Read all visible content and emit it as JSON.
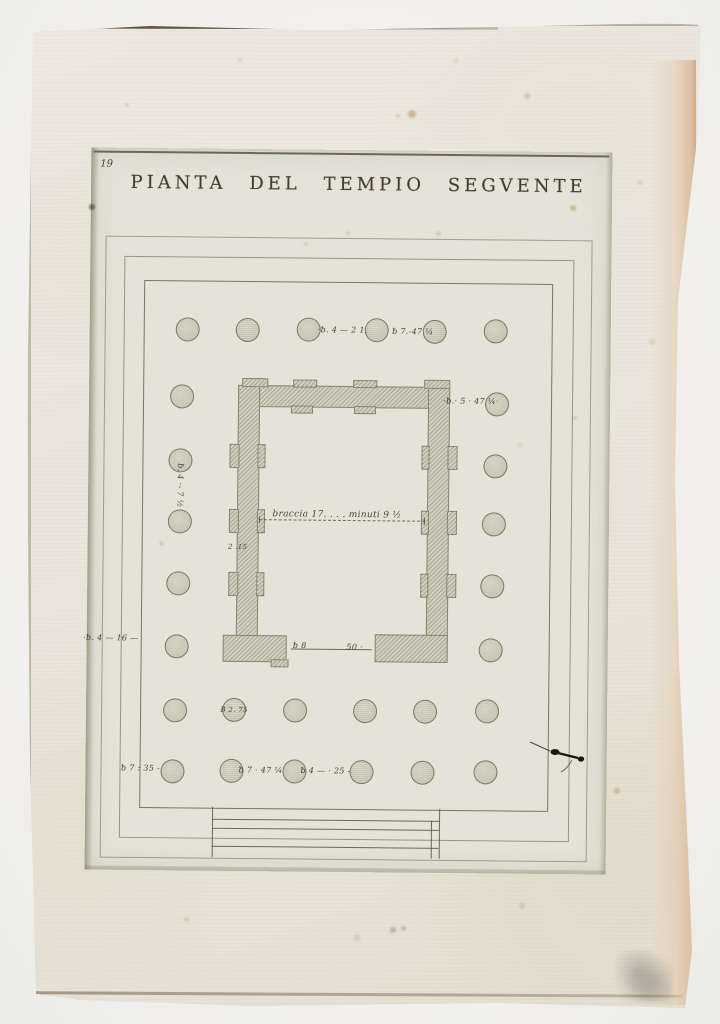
{
  "page": {
    "number": "19",
    "title": "PIANTA DEL TEMPIO SEGVENTE"
  },
  "colors": {
    "paper": "#eae6dc",
    "plate": "#e5e3d8",
    "ink": "#443d2e",
    "annotation_ink": "#483f2f",
    "wall_fill": "#d3d1c1",
    "edge_pink": "#dcc0a2"
  },
  "plan": {
    "origin": {
      "x": 88,
      "y": 150
    },
    "border_rects": [
      {
        "x": 103,
        "y": 238,
        "w": 485,
        "h": 620,
        "o": 0.5
      },
      {
        "x": 122,
        "y": 258,
        "w": 448,
        "h": 580,
        "o": 0.58
      },
      {
        "x": 142,
        "y": 282,
        "w": 407,
        "h": 526,
        "o": 0.8
      }
    ],
    "columns": {
      "radius": 12,
      "positions": [
        [
          186,
          331
        ],
        [
          246,
          331
        ],
        [
          307,
          330
        ],
        [
          375,
          330
        ],
        [
          433,
          331
        ],
        [
          494,
          330
        ],
        [
          181,
          398
        ],
        [
          496,
          403
        ],
        [
          180,
          462
        ],
        [
          495,
          465
        ],
        [
          180,
          523
        ],
        [
          494,
          523
        ],
        [
          179,
          585
        ],
        [
          493,
          585
        ],
        [
          178,
          648
        ],
        [
          492,
          649
        ],
        [
          177,
          712
        ],
        [
          236,
          711
        ],
        [
          297,
          711
        ],
        [
          367,
          711
        ],
        [
          427,
          711
        ],
        [
          489,
          710
        ],
        [
          175,
          773
        ],
        [
          234,
          772
        ],
        [
          297,
          772
        ],
        [
          364,
          772
        ],
        [
          425,
          772
        ],
        [
          488,
          771
        ]
      ]
    },
    "cella": {
      "blocks": [
        [
          237,
          386,
          212,
          22
        ],
        [
          237,
          386,
          22,
          276
        ],
        [
          427,
          386,
          22,
          274
        ],
        [
          224,
          636,
          64,
          27
        ],
        [
          376,
          634,
          73,
          28
        ],
        [
          241,
          379,
          26,
          9
        ],
        [
          292,
          380,
          24,
          8
        ],
        [
          352,
          380,
          24,
          8
        ],
        [
          423,
          379,
          26,
          9
        ],
        [
          290,
          406,
          22,
          8
        ],
        [
          353,
          406,
          22,
          8
        ],
        [
          229,
          445,
          10,
          24
        ],
        [
          229,
          510,
          10,
          24
        ],
        [
          229,
          573,
          10,
          24
        ],
        [
          257,
          445,
          8,
          24
        ],
        [
          257,
          510,
          8,
          24
        ],
        [
          257,
          573,
          8,
          24
        ],
        [
          447,
          445,
          10,
          24
        ],
        [
          447,
          510,
          10,
          24
        ],
        [
          447,
          573,
          10,
          24
        ],
        [
          421,
          445,
          8,
          24
        ],
        [
          421,
          510,
          8,
          24
        ],
        [
          421,
          573,
          8,
          24
        ],
        [
          272,
          660,
          18,
          8
        ]
      ]
    },
    "lines": [
      {
        "x": 259,
        "y": 520,
        "len": 166,
        "dir": "h",
        "dash": true,
        "name": "cella-width-dashed-line"
      },
      {
        "x": 259,
        "y": 517,
        "len": 7,
        "dir": "v",
        "dash": false,
        "name": "dashed-line-tick"
      },
      {
        "x": 424,
        "y": 517,
        "len": 7,
        "dir": "v",
        "dash": false,
        "name": "dashed-line-tick"
      },
      {
        "x": 292,
        "y": 649,
        "len": 81,
        "dir": "h",
        "dash": false,
        "name": "door-width-line"
      },
      {
        "x": 215,
        "y": 820,
        "len": 227,
        "dir": "h",
        "dash": false,
        "name": "steps-line"
      },
      {
        "x": 215,
        "y": 829,
        "len": 227,
        "dir": "h",
        "dash": false,
        "name": "steps-line"
      },
      {
        "x": 215,
        "y": 847,
        "len": 227,
        "dir": "h",
        "dash": false,
        "name": "steps-line"
      },
      {
        "x": 215,
        "y": 808,
        "len": 50,
        "dir": "v",
        "dash": false,
        "name": "steps-edge"
      },
      {
        "x": 442,
        "y": 808,
        "len": 50,
        "dir": "v",
        "dash": false,
        "name": "steps-edge"
      },
      {
        "x": 434,
        "y": 820,
        "len": 38,
        "dir": "v",
        "dash": false,
        "name": "steps-edge"
      }
    ],
    "annotations": [
      {
        "t": "·ƀ. 4 — 2 1.",
        "x": 341,
        "y": 330,
        "s": 8
      },
      {
        "t": "ƀ 7.-47 ¼",
        "x": 411,
        "y": 331,
        "s": 8
      },
      {
        "t": "·ƀ.· 5 · 47 ¼·",
        "x": 470,
        "y": 400,
        "s": 8
      },
      {
        "t": "ƀ. 4 ·- 7 ½",
        "x": 180,
        "y": 487,
        "s": 8,
        "r": 90
      },
      {
        "t": "2 .15",
        "x": 238,
        "y": 548,
        "s": 7
      },
      {
        "t": "braccia 17. . . .  minuti 9 ½",
        "x": 337,
        "y": 515,
        "s": 9
      },
      {
        "t": "·ƀ. 4 — 16 —",
        "x": 112,
        "y": 640,
        "s": 8
      },
      {
        "t": "ƀ 8",
        "x": 301,
        "y": 646,
        "s": 8
      },
      {
        "t": "50 ·",
        "x": 356,
        "y": 647,
        "s": 8
      },
      {
        "t": "B 2. 75",
        "x": 236,
        "y": 711,
        "s": 7
      },
      {
        "t": "ƀ 7 : 35 -",
        "x": 143,
        "y": 770,
        "s": 8
      },
      {
        "t": "ƀ 7 · 47 ¼",
        "x": 263,
        "y": 771,
        "s": 8
      },
      {
        "t": "ƀ 4 — · 25 -",
        "x": 328,
        "y": 771,
        "s": 8
      }
    ]
  },
  "marks": {
    "spots": [
      [
        412,
        114,
        4,
        "#b08a52",
        0.5
      ],
      [
        527,
        96,
        3,
        "#bd9a62",
        0.45
      ],
      [
        573,
        208,
        3,
        "#ae8a50",
        0.5
      ],
      [
        438,
        233,
        2.5,
        "#bd9a62",
        0.4
      ],
      [
        556,
        181,
        2,
        "#b08a52",
        0.35
      ],
      [
        640,
        182,
        2.5,
        "#c7ae85",
        0.4
      ],
      [
        652,
        342,
        3,
        "#c9b38c",
        0.4
      ],
      [
        306,
        244,
        2,
        "#ab8d60",
        0.3
      ],
      [
        617,
        791,
        3,
        "#b08a52",
        0.45
      ],
      [
        522,
        906,
        3,
        "#c2a87e",
        0.4
      ],
      [
        186,
        919,
        2.5,
        "#bd9a62",
        0.35
      ],
      [
        398,
        116,
        2,
        "#bd9a62",
        0.3
      ],
      [
        92,
        207,
        3,
        "#413a2d",
        0.65
      ],
      [
        161,
        543,
        1.5,
        "#6d6248",
        0.4
      ],
      [
        348,
        233,
        2,
        "#b59a6e",
        0.3
      ],
      [
        393,
        930,
        3,
        "#8d8880",
        0.5
      ],
      [
        403,
        928,
        2.5,
        "#8d8880",
        0.45
      ],
      [
        357,
        938,
        3,
        "#9b968e",
        0.3
      ],
      [
        240,
        60,
        2,
        "#c2a87e",
        0.35
      ],
      [
        455,
        60,
        2.5,
        "#c2a87e",
        0.3
      ],
      [
        575,
        418,
        2,
        "#b59a6e",
        0.35
      ],
      [
        520,
        445,
        2,
        "#c2a87e",
        0.3
      ],
      [
        127,
        105,
        2,
        "#b59a6e",
        0.3
      ]
    ]
  }
}
